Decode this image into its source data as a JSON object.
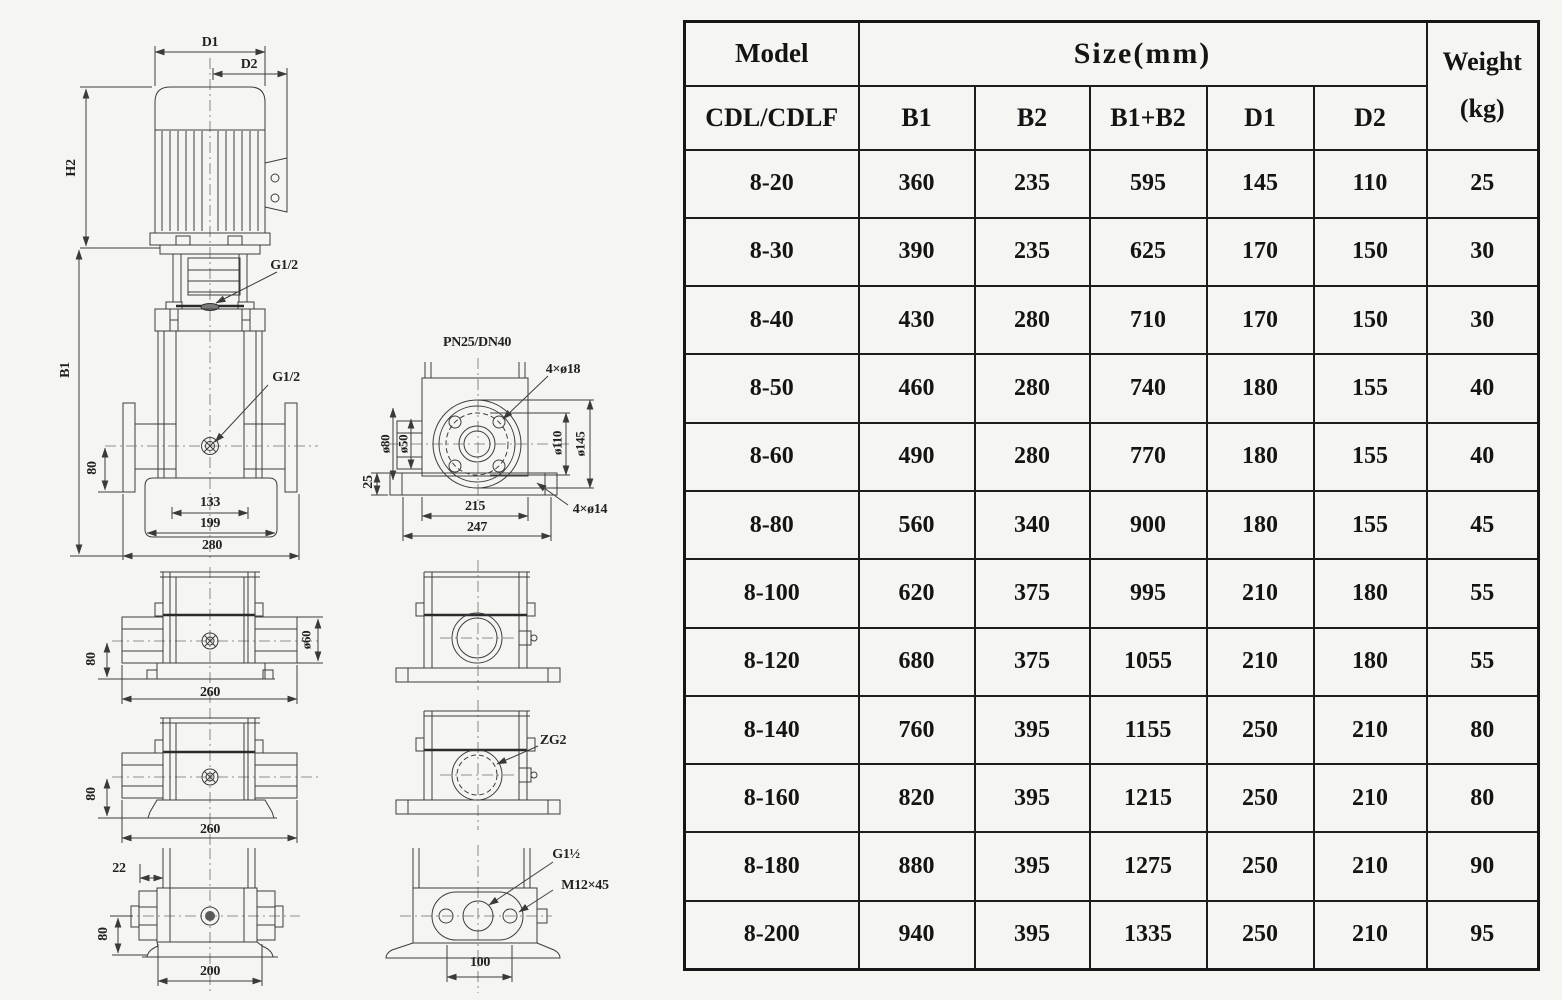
{
  "page": {
    "background": "#f5f5f2",
    "ink": "#1d1d1d"
  },
  "drawing": {
    "labels": {
      "d1": "D1",
      "d2": "D2",
      "h2": "H2",
      "b1": "B1",
      "g_half_top": "G1/2",
      "g_half_port": "G1/2",
      "dim_80_front": "80",
      "dim_133": "133",
      "dim_199": "199",
      "dim_280": "280",
      "flange_spec": "PN25/DN40",
      "bolt_circle_holes": "4×ø18",
      "dia_80": "ø80",
      "dia_50": "ø50",
      "dia_110": "ø110",
      "dia_145": "ø145",
      "dim_25": "25",
      "dim_215": "215",
      "dim_247": "247",
      "base_holes": "4×ø14",
      "dim_80_inline": "80",
      "dia_60": "ø60",
      "dim_260_inline": "260",
      "dim_80_lower": "80",
      "dim_260_lower": "260",
      "dim_22": "22",
      "dim_80_threaded": "80",
      "dim_200": "200",
      "zg2": "ZG2",
      "g1_half": "G1½",
      "m12x45": "M12×45",
      "dim_100": "100"
    }
  },
  "table": {
    "header": {
      "model": "Model",
      "model_sub": "CDL/CDLF",
      "size_group": "Size(mm)",
      "weight_line1": "Weight",
      "weight_line2": "(kg)",
      "size_cols": [
        "B1",
        "B2",
        "B1+B2",
        "D1",
        "D2"
      ]
    },
    "col_keys": [
      "model",
      "b1",
      "b2",
      "b1-plus-b2",
      "d1",
      "d2",
      "weight"
    ],
    "rows": [
      {
        "cells": [
          "8-20",
          "360",
          "235",
          "595",
          "145",
          "110",
          "25"
        ]
      },
      {
        "cells": [
          "8-30",
          "390",
          "235",
          "625",
          "170",
          "150",
          "30"
        ]
      },
      {
        "cells": [
          "8-40",
          "430",
          "280",
          "710",
          "170",
          "150",
          "30"
        ]
      },
      {
        "cells": [
          "8-50",
          "460",
          "280",
          "740",
          "180",
          "155",
          "40"
        ]
      },
      {
        "cells": [
          "8-60",
          "490",
          "280",
          "770",
          "180",
          "155",
          "40"
        ]
      },
      {
        "cells": [
          "8-80",
          "560",
          "340",
          "900",
          "180",
          "155",
          "45"
        ]
      },
      {
        "cells": [
          "8-100",
          "620",
          "375",
          "995",
          "210",
          "180",
          "55"
        ]
      },
      {
        "cells": [
          "8-120",
          "680",
          "375",
          "1055",
          "210",
          "180",
          "55"
        ]
      },
      {
        "cells": [
          "8-140",
          "760",
          "395",
          "1155",
          "250",
          "210",
          "80"
        ]
      },
      {
        "cells": [
          "8-160",
          "820",
          "395",
          "1215",
          "250",
          "210",
          "80"
        ]
      },
      {
        "cells": [
          "8-180",
          "880",
          "395",
          "1275",
          "250",
          "210",
          "90"
        ]
      },
      {
        "cells": [
          "8-200",
          "940",
          "395",
          "1335",
          "250",
          "210",
          "95"
        ]
      }
    ]
  }
}
